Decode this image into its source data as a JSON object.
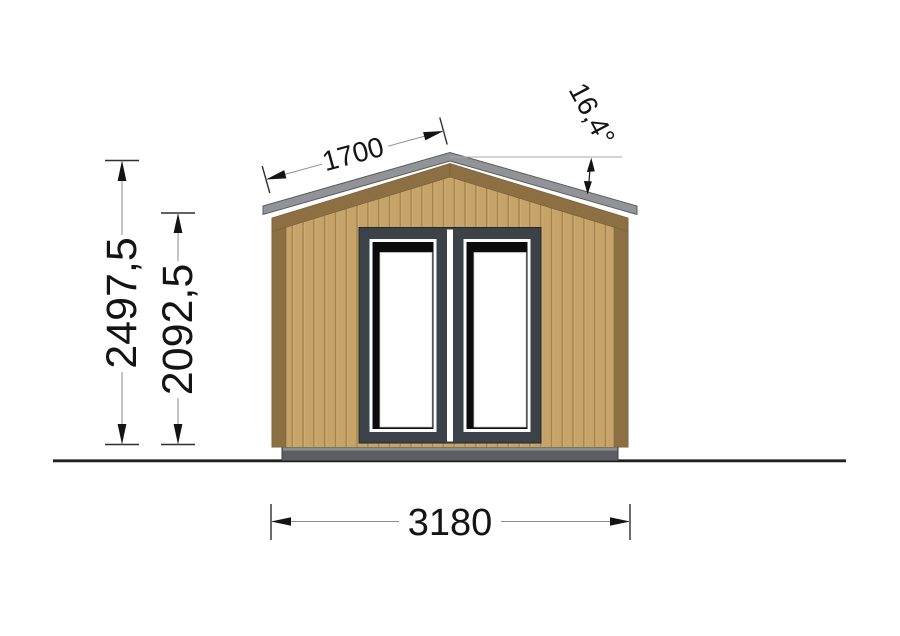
{
  "drawing": {
    "type": "front-elevation",
    "subject": "garden cabin with double glazed doors, gabled roof",
    "dimensions": {
      "total_height": "2497,5",
      "wall_height": "2092,5",
      "roof_slope_length": "1700",
      "roof_angle": "16,4°",
      "total_width": "3180"
    },
    "colors": {
      "background": "#ffffff",
      "wood_facade": "#c6a469",
      "wood_plank_groove": "#a3824c",
      "wood_trim": "#8c7043",
      "roof_fascia": "#919396",
      "door_frame": "#3b4248",
      "door_glass_shadow": "#0b0b0b",
      "door_glass": "#ffffff",
      "foundation_base": "#5b5f64",
      "ground_line": "#202020",
      "dimension_text": "#141414"
    }
  }
}
